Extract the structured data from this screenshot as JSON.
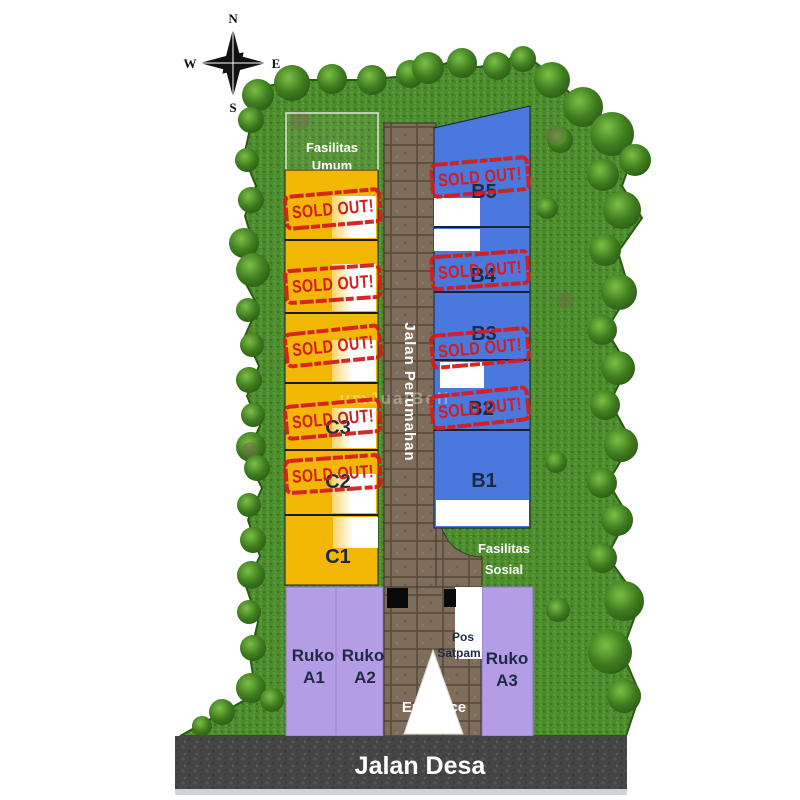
{
  "compass": {
    "north": "N",
    "south": "S",
    "east": "E",
    "west": "W"
  },
  "areas": {
    "fasilitas_umum": {
      "line1": "Fasilitas",
      "line2": "Umum"
    },
    "fasilitas_sosial": {
      "line1": "Fasilitas",
      "line2": "Sosial"
    }
  },
  "roads": {
    "main_label": "Jalan Perumahan",
    "village_label": "Jalan Desa",
    "entrance_label": "Entrance"
  },
  "security": {
    "line1": "Pos",
    "line2": "Satpam"
  },
  "stamp": {
    "text": "SOLD OUT!",
    "color": "#d41c1c"
  },
  "blocks": {
    "c": {
      "color": "#f2b705",
      "units": [
        {
          "label": "",
          "sold": true
        },
        {
          "label": "",
          "sold": true
        },
        {
          "label": "",
          "sold": true
        },
        {
          "label": "C3",
          "sold": true
        },
        {
          "label": "C2",
          "sold": true
        },
        {
          "label": "C1",
          "sold": false
        }
      ]
    },
    "b": {
      "color": "#4b78dd",
      "units": [
        {
          "label": "B5",
          "sold": true
        },
        {
          "label": "B4",
          "sold": true
        },
        {
          "label": "B3",
          "sold": true
        },
        {
          "label": "B2",
          "sold": true
        },
        {
          "label": "B1",
          "sold": false
        }
      ]
    },
    "a": {
      "color": "#b49de4",
      "units": [
        {
          "line1": "Ruko",
          "line2": "A1"
        },
        {
          "line1": "Ruko",
          "line2": "A2"
        },
        {
          "line1": "Ruko",
          "line2": "A3"
        }
      ]
    }
  },
  "watermark": {
    "text": "umJualBeli"
  },
  "colors": {
    "grass": "#4c8b2c",
    "tree_dark": "#2e5e18",
    "road_paving": "#7e6d5a",
    "asphalt": "#474747",
    "block_c_yellow": "#f2b705",
    "block_b_blue": "#4b78dd",
    "block_a_purple": "#b49de4",
    "stamp_red": "#d41c1c",
    "label_navy": "#1e2a44",
    "white": "#ffffff"
  }
}
